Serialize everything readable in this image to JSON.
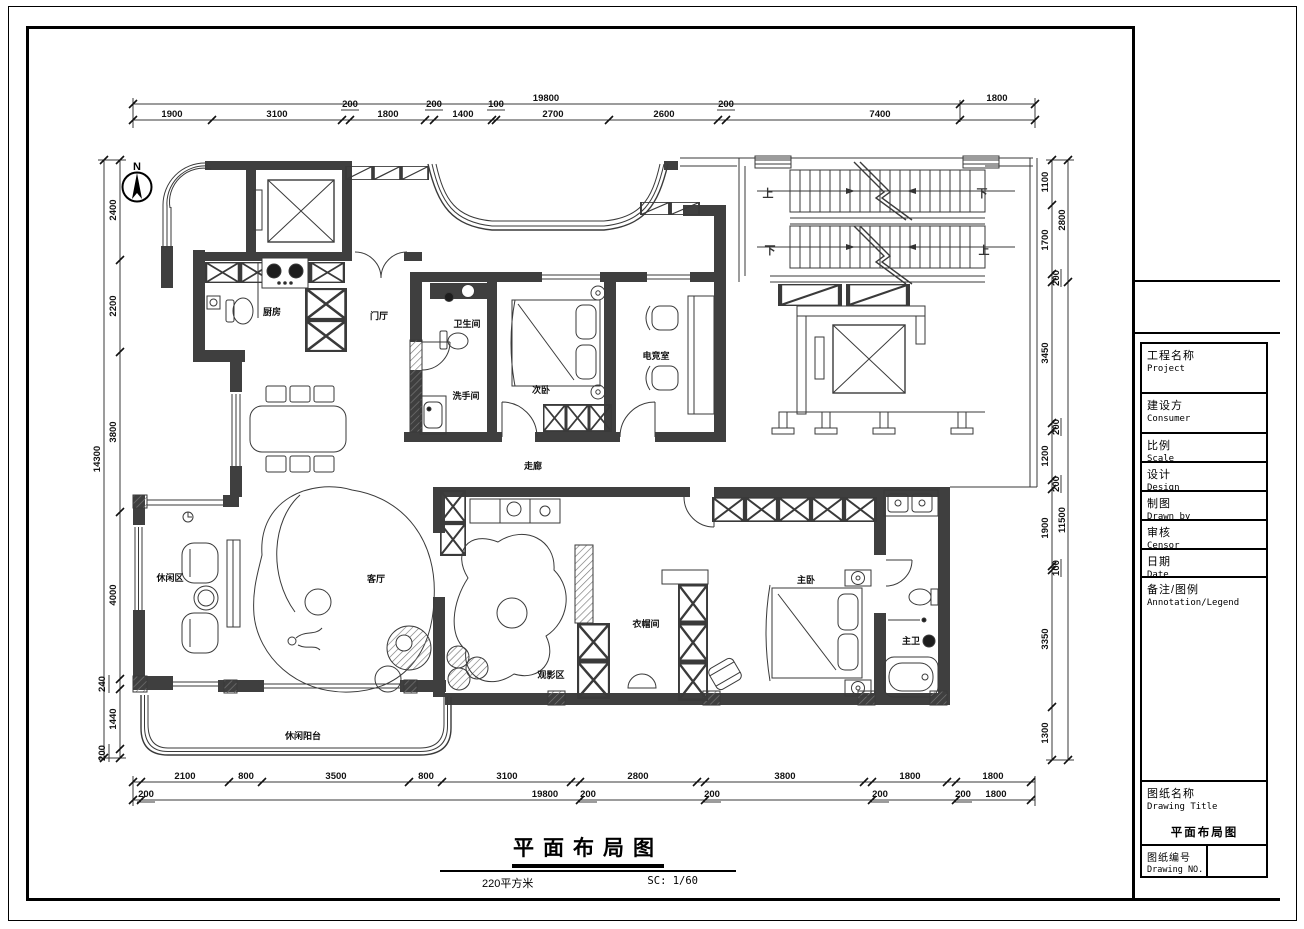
{
  "sheet": {
    "bg": "#ffffff",
    "line_color": "#3a3a3a",
    "wall_color": "#3f3f3f"
  },
  "compass": {
    "label": "N"
  },
  "rooms": {
    "kitchen": "厨房",
    "foyer": "门厅",
    "bath": "卫生间",
    "washroom": "洗手间",
    "bedroom2": "次卧",
    "esports": "电竞室",
    "corridor": "走廊",
    "leisure": "休闲区",
    "living": "客厅",
    "cinema": "观影区",
    "cloakroom": "衣帽间",
    "master": "主卧",
    "master_bath": "主卫",
    "balcony": "休闲阳台"
  },
  "stairs": {
    "up": "上",
    "down": "下"
  },
  "dims": {
    "top_overall": [
      "19800",
      "1800"
    ],
    "top": [
      "1900",
      "3100",
      "200",
      "1800",
      "200",
      "1400",
      "100",
      "2700",
      "2600",
      "200",
      "7400"
    ],
    "bottom": [
      "2100",
      "800",
      "3500",
      "800",
      "3100",
      "2800",
      "3800",
      "1800",
      "1800"
    ],
    "bottom2": [
      "200",
      "19800",
      "200",
      "200",
      "200",
      "200",
      "1800"
    ],
    "left_overall": "14300",
    "left": [
      "2400",
      "2200",
      "3800",
      "4000",
      "240",
      "1440",
      "200"
    ],
    "right": [
      "1100",
      "1700",
      "200",
      "3450",
      "200",
      "1200",
      "200",
      "1900",
      "100",
      "3350",
      "1300"
    ],
    "right_outer": [
      "2800",
      "11500"
    ]
  },
  "footer": {
    "title": "平面布局图",
    "area": "220平方米",
    "scale": "SC: 1/60"
  },
  "title_block": {
    "rows": [
      {
        "zh": "工程名称",
        "en": "Project"
      },
      {
        "zh": "建设方",
        "en": "Consumer"
      },
      {
        "zh": "比例",
        "en": "Scale"
      },
      {
        "zh": "设计",
        "en": "Design"
      },
      {
        "zh": "制图",
        "en": "Drawn by"
      },
      {
        "zh": "审核",
        "en": "Censor"
      },
      {
        "zh": "日期",
        "en": "Date"
      },
      {
        "zh": "备注/图例",
        "en": "Annotation/Legend"
      }
    ],
    "drawing_title": {
      "zh": "图纸名称",
      "en": "Drawing Title",
      "value": "平面布局图"
    },
    "drawing_no": {
      "zh": "图纸编号",
      "en": "Drawing NO."
    }
  }
}
